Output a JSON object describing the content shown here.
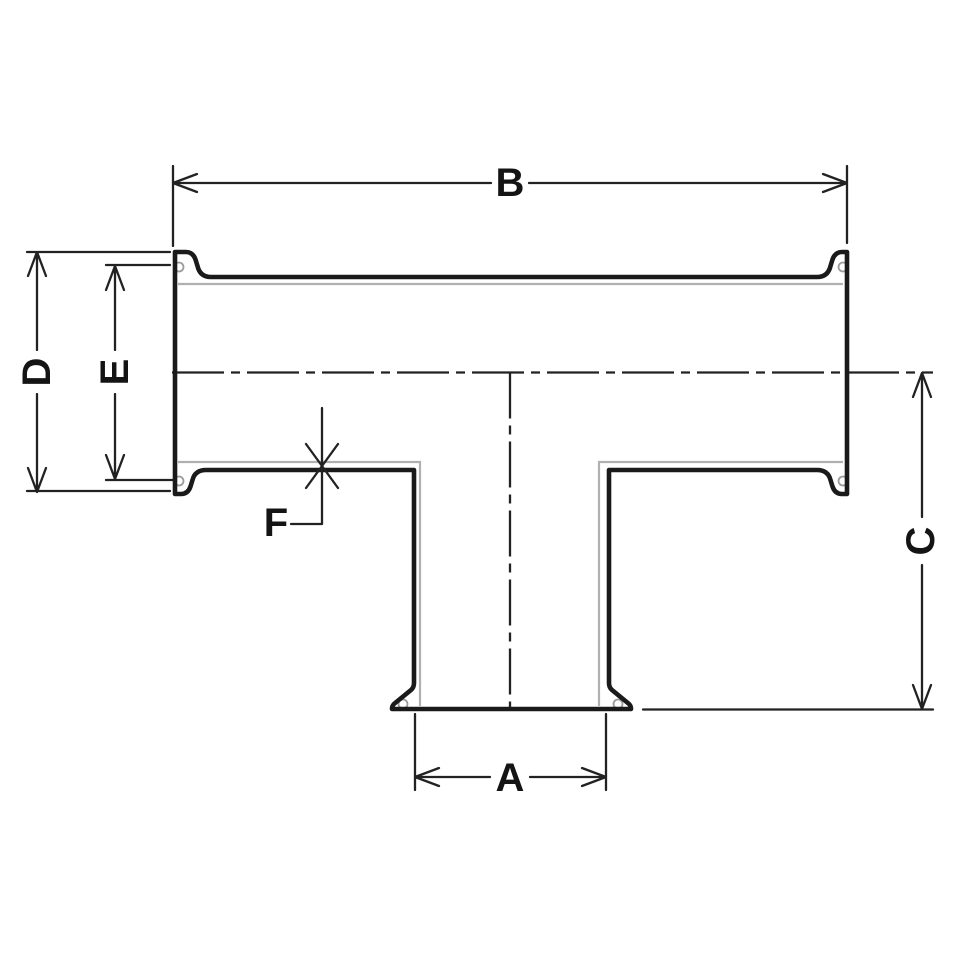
{
  "drawing": {
    "name": "Clamp tee fitting dimensional drawing (cross-section)",
    "colors": {
      "background": "#ffffff",
      "outline": "#1a1a1a",
      "dimension": "#222222",
      "inner_wall": "#b0b0b0",
      "detail": "#9c9c9c",
      "label": "#141414"
    },
    "dimension_labels": {
      "a": "A",
      "b": "B",
      "c": "C",
      "d": "D",
      "e": "E",
      "f": "F"
    }
  }
}
